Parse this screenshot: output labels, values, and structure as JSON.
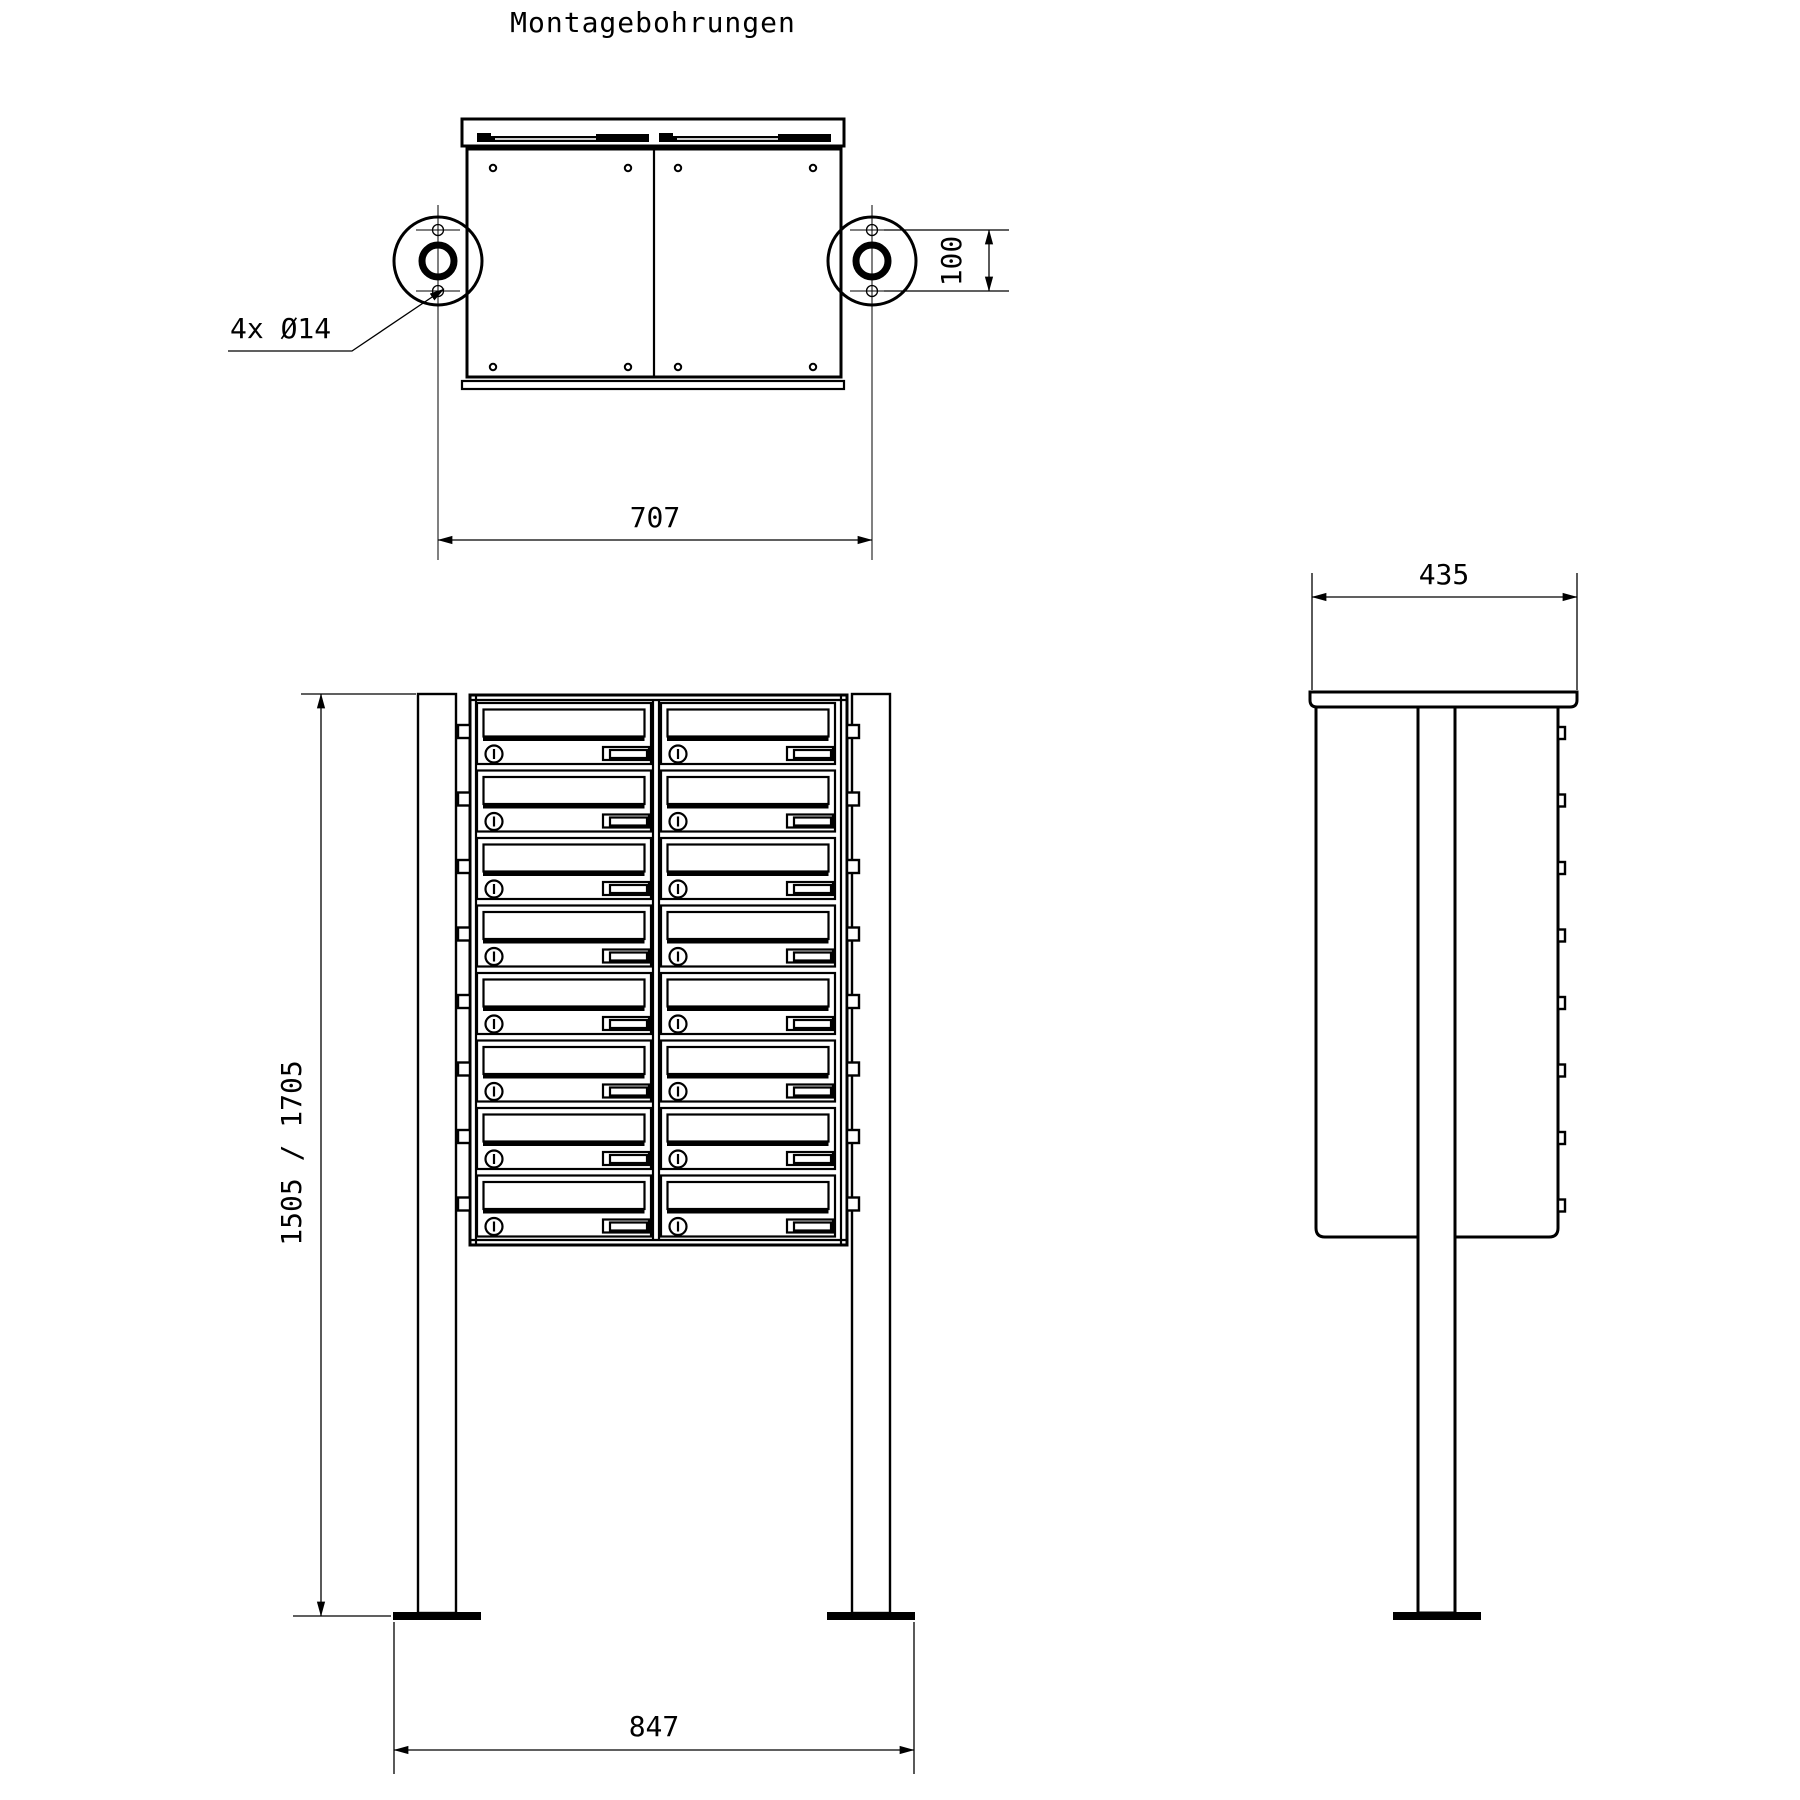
{
  "drawing": {
    "title": "Montagebohrungen",
    "labels": {
      "holes_callout": "4x Ø14"
    },
    "dimensions": {
      "mounting_width": "707",
      "hole_spacing": "100",
      "total_height": "1505 / 1705",
      "base_width": "847",
      "depth": "435"
    },
    "front_view": {
      "box_rows": 8,
      "box_columns": 2
    },
    "colors": {
      "line": "#000000",
      "background": "#ffffff"
    }
  }
}
